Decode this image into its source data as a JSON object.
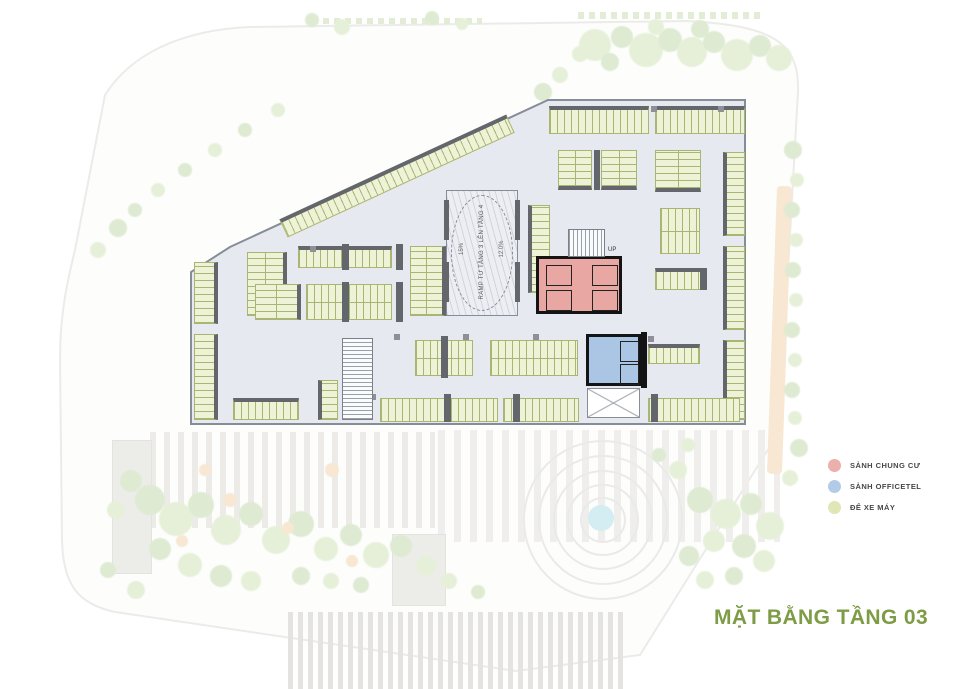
{
  "title": {
    "text": "MẶT BẰNG TẦNG 03",
    "color": "#7d9c45"
  },
  "legend": {
    "items": [
      {
        "label": "SẢNH CHUNG CƯ",
        "color": "#e9a7a3"
      },
      {
        "label": "SẢNH OFFICETEL",
        "color": "#aac6e4"
      },
      {
        "label": "ĐỂ XE MÁY",
        "color": "#dde3ae"
      }
    ]
  },
  "plan": {
    "labels": {
      "ramp": "RAMP TỪ TẦNG 3 LÊN TẦNG 4",
      "slope_left": "15%",
      "slope_right": "12.0%",
      "up": "UP"
    },
    "colors": {
      "floor": "#e7e9f0",
      "wall": "#878d96",
      "stall_fill": "#eef2d6",
      "stall_line": "#a9b573",
      "bar": "#63666b",
      "pillar": "#8d9197",
      "lobby_residential": "#e9a7a3",
      "lobby_officetel": "#aac6e4",
      "core_wall": "#141414",
      "ramp_fill": "#eceef4",
      "hatch": "#8a8f98"
    },
    "outline": "548,100 745,100 745,424 191,424 191,272 230,247",
    "modules": [
      [
        549,
        106,
        100,
        28,
        "v",
        "top",
        0
      ],
      [
        655,
        106,
        90,
        28,
        "v",
        "top",
        0
      ],
      [
        558,
        150,
        34,
        40,
        "h",
        "bottom",
        0
      ],
      [
        601,
        150,
        36,
        40,
        "h",
        "bottom",
        0
      ],
      [
        655,
        150,
        46,
        42,
        "h",
        "bottom",
        0
      ],
      [
        660,
        208,
        40,
        46,
        "v",
        "",
        0
      ],
      [
        655,
        268,
        46,
        22,
        "v",
        "top",
        0
      ],
      [
        723,
        152,
        22,
        84,
        "h",
        "left",
        0
      ],
      [
        723,
        246,
        22,
        84,
        "h",
        "left",
        0
      ],
      [
        723,
        340,
        22,
        80,
        "h",
        "left",
        0
      ],
      [
        272,
        166,
        250,
        20,
        "v",
        "top",
        -24.8
      ],
      [
        194,
        262,
        24,
        62,
        "h",
        "right",
        0
      ],
      [
        194,
        334,
        24,
        86,
        "h",
        "right",
        0
      ],
      [
        247,
        252,
        40,
        64,
        "h",
        "right",
        0
      ],
      [
        298,
        246,
        94,
        22,
        "v",
        "top",
        0
      ],
      [
        255,
        284,
        46,
        36,
        "h",
        "right",
        0
      ],
      [
        306,
        284,
        86,
        36,
        "v",
        "",
        0
      ],
      [
        410,
        246,
        36,
        70,
        "h",
        "right",
        0
      ],
      [
        528,
        205,
        22,
        88,
        "h",
        "left",
        0
      ],
      [
        415,
        340,
        58,
        36,
        "v",
        "",
        0
      ],
      [
        490,
        340,
        88,
        36,
        "v",
        "",
        0
      ],
      [
        318,
        380,
        20,
        40,
        "h",
        "left",
        0
      ],
      [
        233,
        398,
        66,
        22,
        "v",
        "top",
        0
      ],
      [
        380,
        398,
        118,
        24,
        "v",
        "",
        0
      ],
      [
        503,
        398,
        76,
        24,
        "v",
        "",
        0
      ],
      [
        648,
        344,
        52,
        20,
        "v",
        "top",
        0
      ],
      [
        648,
        398,
        92,
        24,
        "v",
        "",
        0
      ]
    ],
    "bars": [
      [
        342,
        244,
        7,
        26
      ],
      [
        396,
        244,
        7,
        26
      ],
      [
        342,
        282,
        7,
        40
      ],
      [
        396,
        282,
        7,
        40
      ],
      [
        441,
        336,
        7,
        42
      ],
      [
        444,
        394,
        7,
        28
      ],
      [
        513,
        394,
        7,
        28
      ],
      [
        651,
        394,
        7,
        28
      ],
      [
        594,
        150,
        6,
        40
      ],
      [
        700,
        268,
        7,
        22
      ]
    ],
    "pillars": [
      [
        394,
        334,
        6,
        6
      ],
      [
        463,
        334,
        6,
        6
      ],
      [
        533,
        334,
        6,
        6
      ],
      [
        607,
        394,
        6,
        6
      ],
      [
        370,
        394,
        6,
        6
      ],
      [
        310,
        246,
        6,
        6
      ],
      [
        460,
        246,
        6,
        6
      ],
      [
        648,
        336,
        6,
        6
      ],
      [
        651,
        106,
        6,
        6
      ],
      [
        718,
        106,
        6,
        6
      ]
    ],
    "ramp": {
      "x": 446,
      "y": 190,
      "w": 72,
      "h": 126,
      "side_bars": [
        [
          444,
          200,
          5,
          40
        ],
        [
          444,
          262,
          5,
          40
        ],
        [
          515,
          200,
          5,
          40
        ],
        [
          515,
          262,
          5,
          40
        ]
      ]
    },
    "cores": {
      "residential": {
        "x": 536,
        "y": 256,
        "w": 86,
        "h": 58,
        "cells": [
          [
            7,
            6,
            26,
            21
          ],
          [
            7,
            31,
            26,
            21
          ],
          [
            53,
            6,
            26,
            21
          ],
          [
            53,
            31,
            26,
            21
          ]
        ]
      },
      "officetel": {
        "x": 586,
        "y": 334,
        "w": 55,
        "h": 52,
        "cells": [
          [
            31,
            4,
            19,
            21
          ],
          [
            31,
            27,
            19,
            21
          ]
        ]
      },
      "wall_stub": [
        641,
        332,
        6,
        56
      ]
    },
    "void_x": [
      587,
      388,
      53,
      30
    ],
    "stairs": [
      [
        568,
        229,
        37,
        28,
        90
      ],
      [
        342,
        338,
        31,
        82,
        0
      ]
    ],
    "up_pos": [
      608,
      247
    ]
  },
  "site": {
    "boundary": "M 250,27 C 180,30 130,55 105,95 L 75,250 C 65,290 60,320 60,360 L 62,540 C 63,585 78,604 115,612 L 516,671 L 640,655 L 779,432 L 798,92 C 800,42 772,25 685,21 Z",
    "boundary_stroke": "#d9d9d4",
    "boundary_fill": "#fcfcfa",
    "tree_colors": [
      "#cfe3b4",
      "#bed8a6"
    ],
    "orange": "#f0d0a8",
    "trees_green": [
      [
        595,
        45,
        16
      ],
      [
        622,
        37,
        11
      ],
      [
        646,
        50,
        17
      ],
      [
        670,
        40,
        12
      ],
      [
        692,
        52,
        15
      ],
      [
        714,
        42,
        11
      ],
      [
        737,
        55,
        16
      ],
      [
        760,
        46,
        11
      ],
      [
        779,
        58,
        13
      ],
      [
        700,
        29,
        9
      ],
      [
        656,
        27,
        8
      ],
      [
        610,
        62,
        9
      ],
      [
        580,
        54,
        8
      ],
      [
        543,
        92,
        9
      ],
      [
        560,
        75,
        8
      ],
      [
        312,
        20,
        7
      ],
      [
        342,
        27,
        8
      ],
      [
        432,
        18,
        7
      ],
      [
        462,
        24,
        6
      ],
      [
        118,
        228,
        9
      ],
      [
        98,
        250,
        8
      ],
      [
        135,
        210,
        7
      ],
      [
        158,
        190,
        7
      ],
      [
        185,
        170,
        7
      ],
      [
        215,
        150,
        7
      ],
      [
        245,
        130,
        7
      ],
      [
        278,
        110,
        7
      ],
      [
        793,
        150,
        9
      ],
      [
        797,
        180,
        7
      ],
      [
        792,
        210,
        8
      ],
      [
        796,
        240,
        7
      ],
      [
        793,
        270,
        8
      ],
      [
        796,
        300,
        7
      ],
      [
        792,
        330,
        8
      ],
      [
        795,
        360,
        7
      ],
      [
        792,
        390,
        8
      ],
      [
        795,
        418,
        7
      ],
      [
        799,
        448,
        9
      ],
      [
        790,
        478,
        8
      ],
      [
        700,
        500,
        13
      ],
      [
        726,
        514,
        15
      ],
      [
        751,
        504,
        11
      ],
      [
        770,
        526,
        14
      ],
      [
        744,
        546,
        12
      ],
      [
        714,
        541,
        11
      ],
      [
        689,
        556,
        10
      ],
      [
        764,
        561,
        11
      ],
      [
        734,
        576,
        9
      ],
      [
        705,
        580,
        9
      ],
      [
        150,
        500,
        15
      ],
      [
        176,
        519,
        17
      ],
      [
        201,
        505,
        13
      ],
      [
        226,
        530,
        15
      ],
      [
        251,
        514,
        12
      ],
      [
        276,
        540,
        14
      ],
      [
        301,
        524,
        13
      ],
      [
        326,
        549,
        12
      ],
      [
        351,
        535,
        11
      ],
      [
        376,
        555,
        13
      ],
      [
        401,
        546,
        11
      ],
      [
        426,
        566,
        10
      ],
      [
        160,
        549,
        11
      ],
      [
        190,
        565,
        12
      ],
      [
        221,
        576,
        11
      ],
      [
        251,
        581,
        10
      ],
      [
        131,
        481,
        11
      ],
      [
        116,
        510,
        9
      ],
      [
        301,
        576,
        9
      ],
      [
        331,
        581,
        8
      ],
      [
        361,
        585,
        8
      ],
      [
        449,
        581,
        8
      ],
      [
        478,
        592,
        7
      ],
      [
        136,
        590,
        9
      ],
      [
        108,
        570,
        8
      ],
      [
        678,
        470,
        9
      ],
      [
        659,
        455,
        7
      ],
      [
        688,
        445,
        7
      ]
    ],
    "trees_orange": [
      [
        230,
        500,
        7
      ],
      [
        352,
        561,
        6
      ],
      [
        182,
        541,
        6
      ],
      [
        288,
        528,
        6
      ],
      [
        332,
        470,
        7
      ],
      [
        205,
        470,
        6
      ]
    ],
    "stripes": [
      [
        150,
        432,
        285,
        96,
        14,
        "#dbd9d3"
      ],
      [
        438,
        430,
        342,
        112,
        16,
        "#e1dfda"
      ],
      [
        288,
        612,
        335,
        77,
        10,
        "#cbc9c4"
      ]
    ],
    "pads": [
      [
        112,
        440,
        38,
        132
      ],
      [
        392,
        534,
        52,
        70
      ]
    ],
    "pad_color": "#dbdbd5",
    "spiral": {
      "cx": 601,
      "cy": 518,
      "rings": [
        78,
        63,
        48,
        34,
        21
      ],
      "ring_color": "#d7d7d2",
      "center_color": "#a8dce8",
      "center_r": 13
    },
    "orange_path": [
      772,
      186,
      15,
      288
    ],
    "trellis": [
      [
        578,
        12,
        185,
        7
      ],
      [
        312,
        18,
        170,
        6
      ]
    ],
    "trellis_color": "#c8dcae"
  }
}
